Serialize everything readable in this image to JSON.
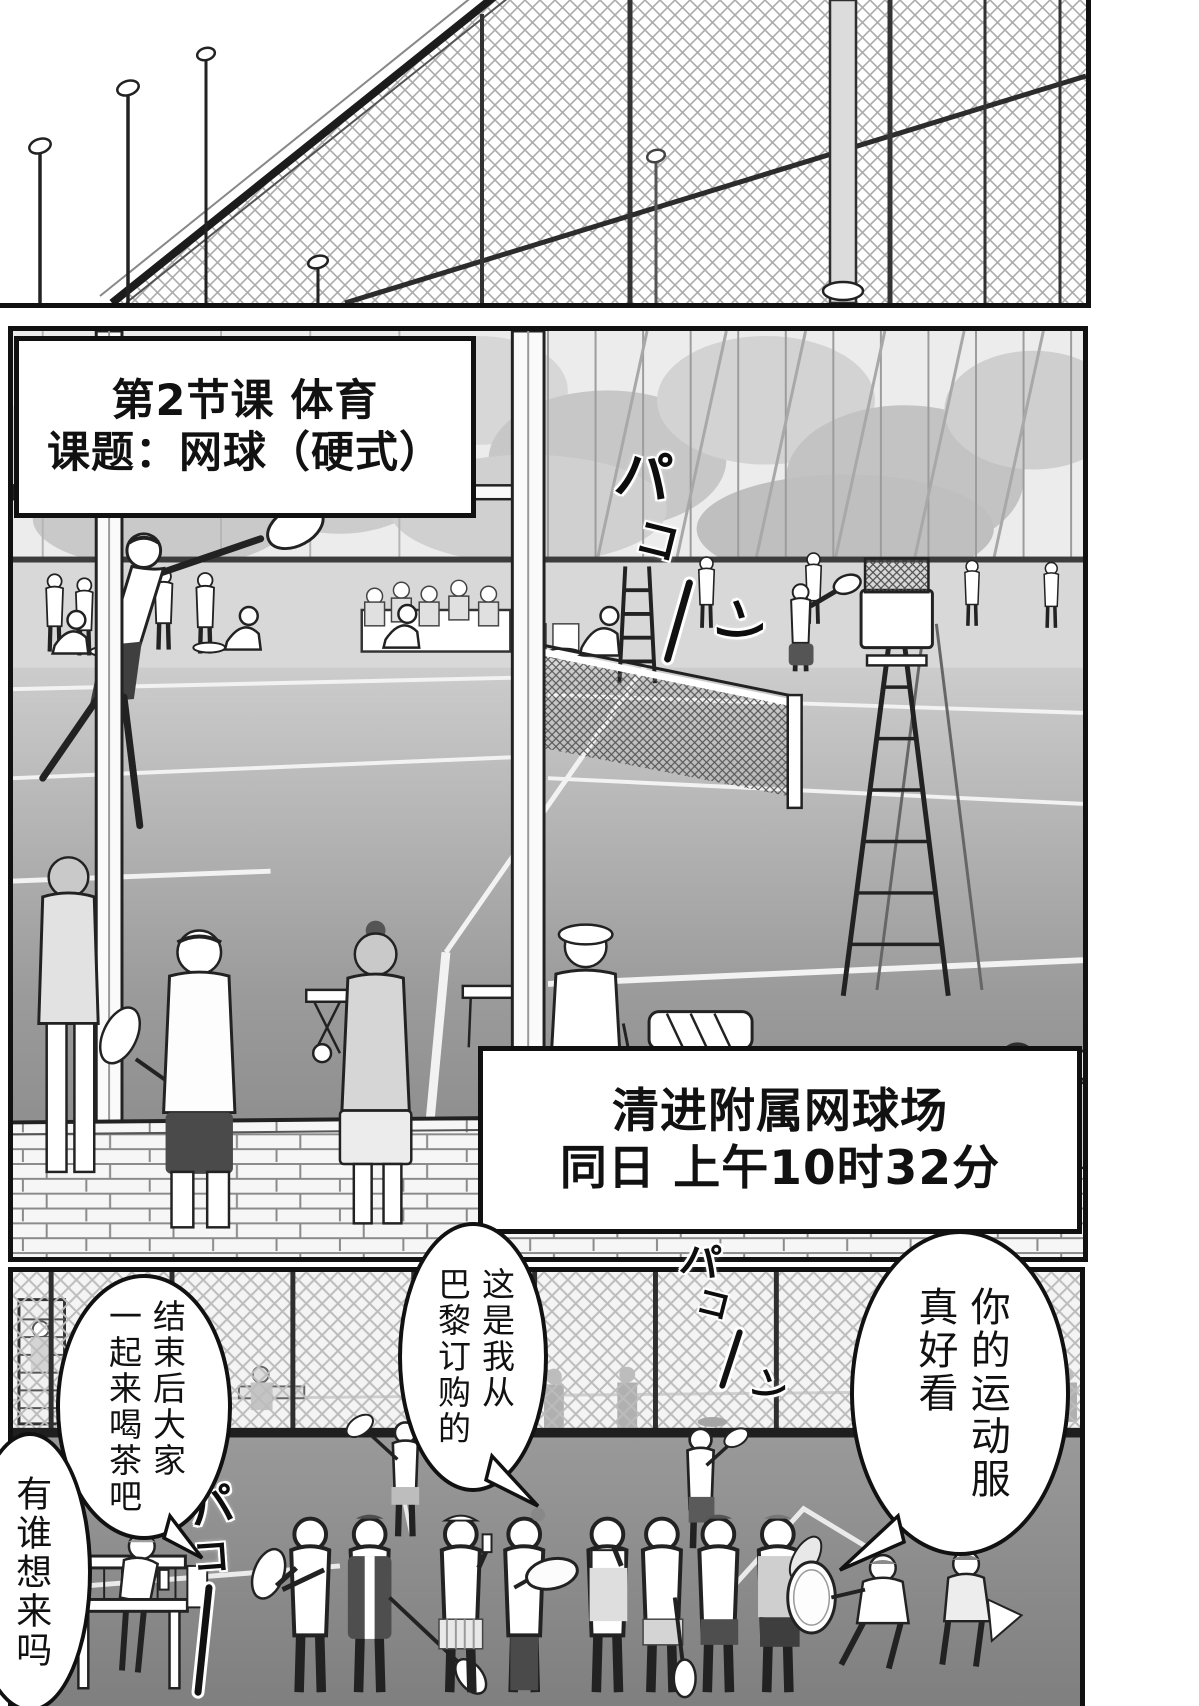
{
  "panel_top_sfx": [
    "バタ",
    "バタ",
    "バタ",
    "バタ"
  ],
  "caption_class": {
    "line1": "第2节课 体育",
    "line2": "课题：网球（硬式）"
  },
  "caption_location": {
    "line1": "清进附属网球场",
    "line2": "同日 上午10时32分"
  },
  "sfx_mid_hit": {
    "c1": "パ",
    "c2": "コ",
    "c3": "ン"
  },
  "sfx_far_hit": {
    "c1": "パ",
    "c2": "コ",
    "c3": "ン"
  },
  "sfx_bench_hit": {
    "c1": "パ",
    "c2": "コ"
  },
  "bubbles": {
    "compliment": {
      "col1": "你的运动服",
      "col2": "真好看"
    },
    "paris": {
      "col1": "这是我从",
      "col2": "巴黎订购的"
    },
    "tea": {
      "col1": "结束后大家",
      "col2": "一起来喝茶吧"
    },
    "invite": {
      "col1": "有谁想来吗"
    }
  }
}
